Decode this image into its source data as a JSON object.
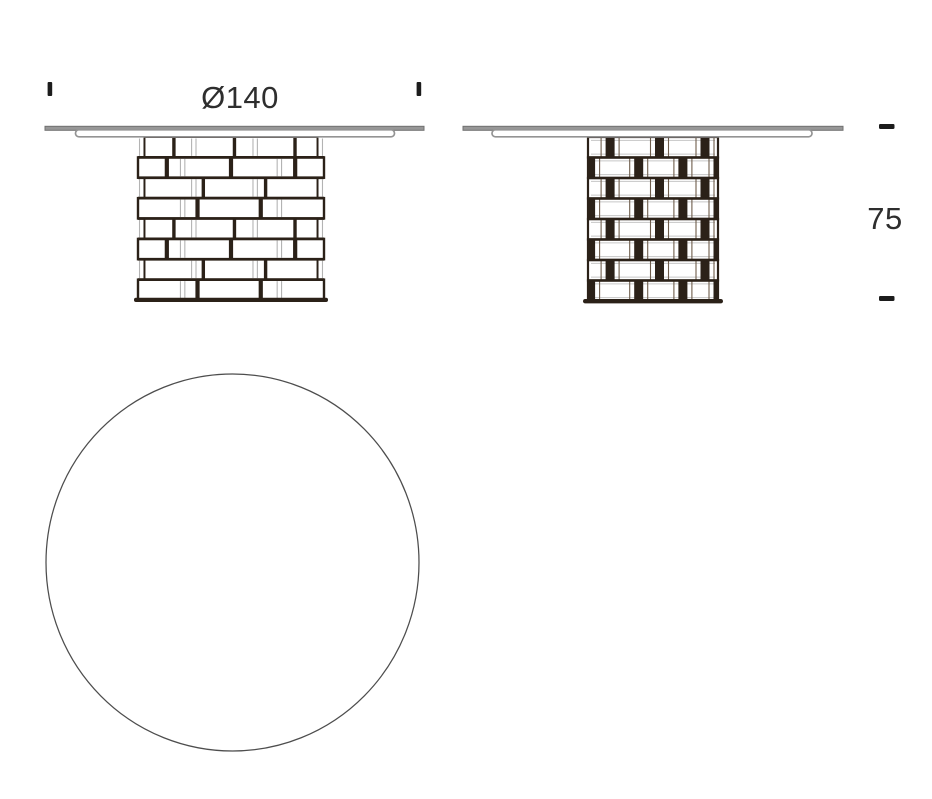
{
  "drawing": {
    "title": "round-pedestal-table-technical-drawing",
    "labels": {
      "diameter": "Ø140",
      "height": "75"
    },
    "colors": {
      "background": "#ffffff",
      "outline_dark": "#2b2118",
      "flank_dark": "#6e5d4c",
      "tabletop_gray": "#979797",
      "tabletop_edge": "#717171",
      "lip_stroke": "#949494",
      "ghost_gray": "#b3b3b3",
      "inner_gray": "#c6c6c6",
      "text": "#2e2e2e",
      "tick": "#1c1c1c",
      "circle_stroke": "#4d4d4d"
    }
  }
}
